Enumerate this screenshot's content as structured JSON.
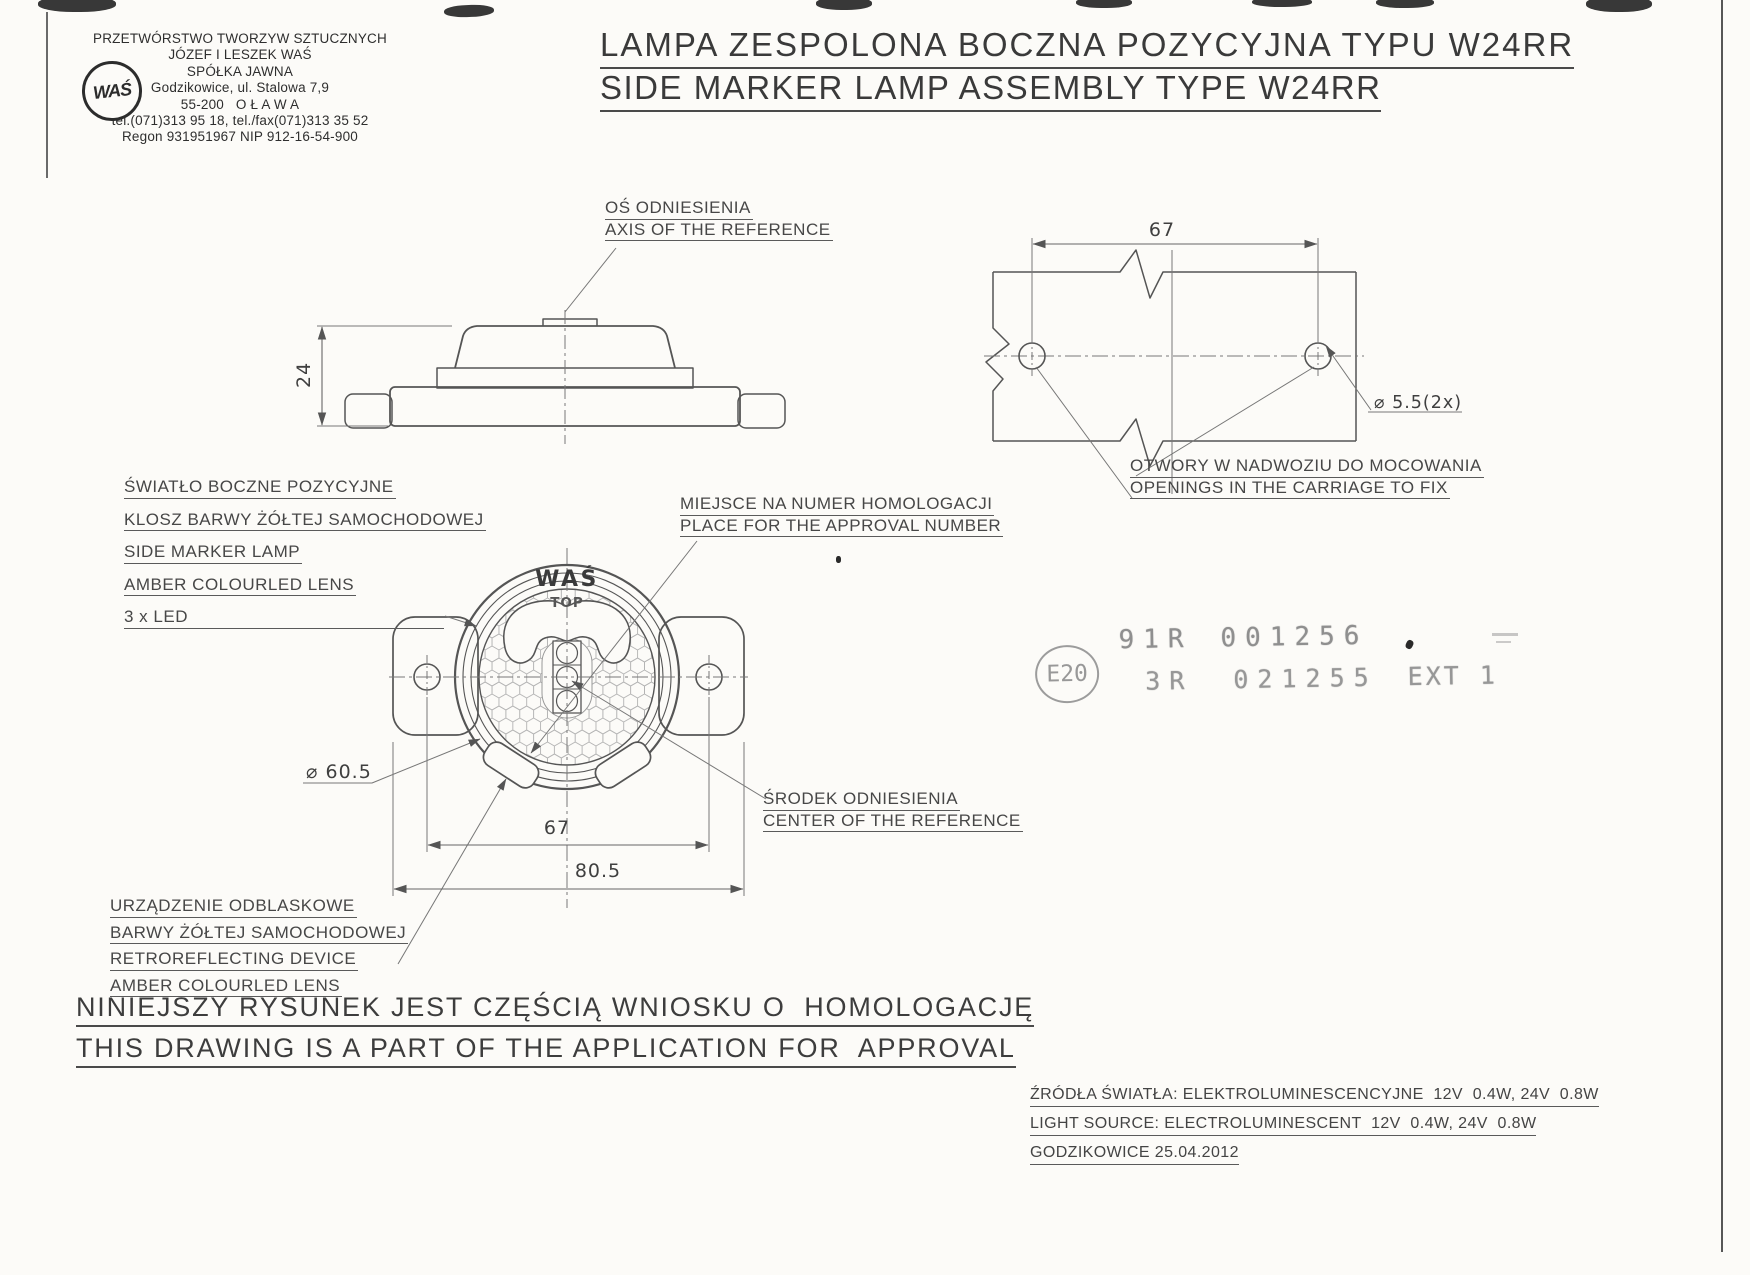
{
  "company": {
    "logo": "WAŚ",
    "lines": [
      "PRZETWÓRSTWO TWORZYW SZTUCZNYCH",
      "JÓZEF I LESZEK WAŚ",
      "SPÓŁKA JAWNA",
      "Godzikowice, ul. Stalowa 7,9",
      "55-200   O Ł A W A",
      "tel.(071)313 95 18, tel./fax(071)313 35 52",
      "Regon 931951967 NIP 912-16-54-900"
    ]
  },
  "title": {
    "pl": "LAMPA ZESPOLONA BOCZNA POZYCYJNA TYPU W24RR",
    "en": "SIDE MARKER LAMP ASSEMBLY TYPE W24RR"
  },
  "callouts": {
    "axis": {
      "pl": "OŚ ODNIESIENIA",
      "en": "AXIS OF THE REFERENCE"
    },
    "side_marker": {
      "lines": [
        "ŚWIATŁO BOCZNE POZYCYJNE",
        "KLOSZ BARWY ŻÓŁTEJ SAMOCHODOWEJ",
        "SIDE MARKER LAMP",
        "AMBER COLOURLED LENS",
        "3 x LED"
      ]
    },
    "approval": {
      "pl": "MIEJSCE NA NUMER HOMOLOGACJI",
      "en": "PLACE FOR THE APPROVAL NUMBER"
    },
    "openings": {
      "pl": "OTWORY W NADWOZIU DO MOCOWANIA",
      "en": "OPENINGS IN THE CARRIAGE TO FIX"
    },
    "center": {
      "pl": "ŚRODEK ODNIESIENIA",
      "en": "CENTER OF THE REFERENCE"
    },
    "retro": {
      "lines": [
        "URZĄDZENIE ODBLASKOWE",
        "BARWY ŻÓŁTEJ SAMOCHODOWEJ",
        "RETROREFLECTING DEVICE",
        "AMBER COLOURLED LENS"
      ]
    }
  },
  "dimensions": {
    "body_height": "24",
    "hole_spacing_plate": "67",
    "hole_dia": "⌀ 5.5(2x)",
    "lens_dia": "⌀ 60.5",
    "hole_spacing_lamp": "67",
    "overall_width": "80.5"
  },
  "lamp_markings": {
    "brand": "WAŚ",
    "top": "TOP"
  },
  "stamp": {
    "e_circle": "E20",
    "row1_code": "91R",
    "row1_num": "001256",
    "row2_code": "3R",
    "row2_num": "021255",
    "row2_ext": "EXT 1"
  },
  "footer": {
    "note_pl": "NINIEJSZY RYSUNEK JEST CZĘŚCIĄ WNIOSKU O  HOMOLOGACJĘ",
    "note_en": "THIS DRAWING IS A PART OF THE APPLICATION FOR  APPROVAL"
  },
  "info": {
    "source_pl": "ŹRÓDŁA ŚWIATŁA: ELEKTROLUMINESCENCYJNE  12V  0.4W, 24V  0.8W",
    "source_en": "LIGHT SOURCE: ELECTROLUMINESCENT  12V  0.4W, 24V  0.8W",
    "place_date": "GODZIKOWICE 25.04.2012"
  },
  "colors": {
    "ink": "#4f4f4f",
    "stamp_gray": "#8f8f8f",
    "paper": "#fcfbf8"
  }
}
